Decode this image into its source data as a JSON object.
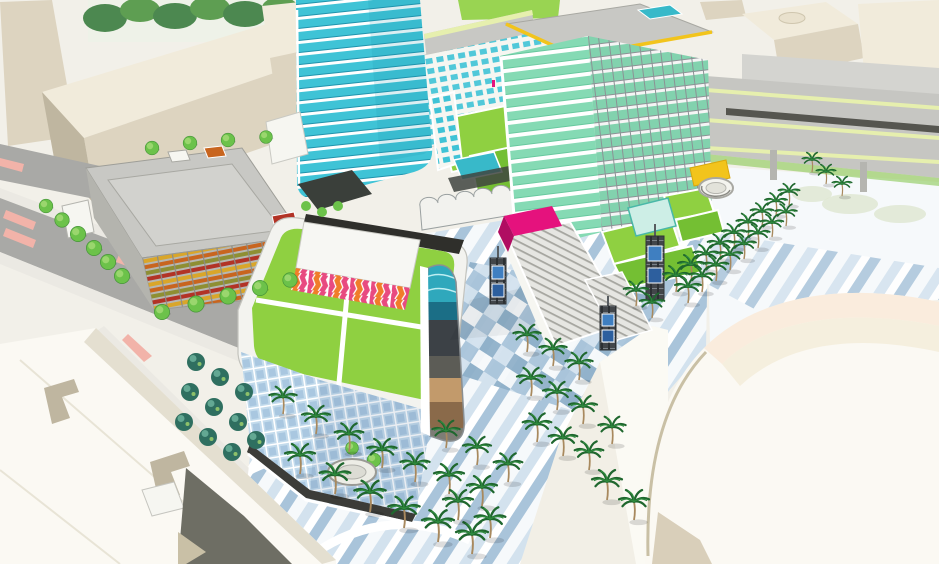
{
  "meta": {
    "title": "Aerial architectural rendering of a mixed-use transit-oriented development with towers, green roofs, palm-lined plaza, parking garage, elevated rail and arena"
  },
  "palette": {
    "bg": "#f2f0e9",
    "street": "#a9a9a6",
    "street_dark": "#80807b",
    "sidewalk": "#ebe9e3",
    "crosswalk_pink": "#f2b3a9",
    "massing_light": "#f1ebdb",
    "massing_mid": "#ddd4c0",
    "massing_dark": "#bfb6a0",
    "tree_green": "#6cc24a",
    "tree_dark": "#47953a",
    "bosque_teal": "#2f6f60",
    "bosque_light": "#63a893",
    "palm_green": "#2f8b3e",
    "palm_dark": "#1f672e",
    "palm_trunk": "#a8895e",
    "tower_cyan": "#3fc3d6",
    "tower_cyan_deep": "#1f93ac",
    "tower_mint": "#85dab4",
    "tower_mint_deep": "#67c89e",
    "mullion": "#8f9699",
    "band_white": "#ffffff",
    "roof_gray": "#c8c8c4",
    "roof_yellow": "#f2c41c",
    "rail_gray": "#c6c6c2",
    "rail_yellow": "#e6efae",
    "rail_dark": "#55554f",
    "lawn": "#8fd041",
    "lawn_deep": "#74bf33",
    "garage_gray": "#b7b7b1",
    "louver_orange": "#c8651f",
    "louver_red": "#b23326",
    "louver_olive": "#8e8f33",
    "louver_amber": "#d9a62a",
    "chevron_pink": "#e84a80",
    "chevron_orange": "#f07d2a",
    "glass_blue": "#c3dbec",
    "glass_blue_deep": "#8fb4d4",
    "mural_teal": "#2fa8bc",
    "mural_deep": "#1b6e86",
    "mural_dark": "#3c4146",
    "mural_tan": "#c29a6b",
    "mural_brown": "#8a6a4a",
    "plaza_white": "#f6f9fb",
    "plaza_blue1": "#d3e2ee",
    "plaza_blue2": "#a9c4da",
    "plaza_blue3": "#8fb0c9",
    "magenta": "#e5127d",
    "magenta_deep": "#b00d62",
    "steel": "#45494c",
    "screen_blue": "#3f7fc1",
    "arena_white": "#fbf9f3",
    "arena_peach": "#f9e7d3",
    "arena_cream": "#f4ecd8",
    "arena_line": "#c9c0a5",
    "pool": "#38b9c9",
    "canopy_dark": "#3a3f3a",
    "white_soft": "#f6f6f1"
  },
  "scene": {
    "elements": [
      {
        "name": "cyan-glass-tower",
        "description": "curved curtain-wall tower, cyan glass with white floor bands, upper left of center"
      },
      {
        "name": "mint-glass-tower",
        "description": "13-story tower, mint green glass, rounded white balcony bands, gray roof with yellow trim and rooftop pool"
      },
      {
        "name": "central-green-roof-building",
        "description": "podium building with rooftop lawn and white walkways"
      },
      {
        "name": "chevron-rooftop-pavilion",
        "description": "rooftop volume clad in pink/orange zigzag chevron pattern"
      },
      {
        "name": "mural-corner-screen",
        "description": "curved corner art wall with teal wave and earth-tone bands"
      },
      {
        "name": "parking-garage",
        "description": "garage with multicolored orange/red/olive louvers and gray roof deck"
      },
      {
        "name": "midrise-residential-block",
        "description": "white bar building with teal windows, green roof terraces, scalloped canopy"
      },
      {
        "name": "grand-stair",
        "description": "wide plaza staircase with magenta escalator canopy"
      },
      {
        "name": "plaza-paving",
        "description": "white and blue striped/checkered paving"
      },
      {
        "name": "lattice-art-towers",
        "description": "dark steel trellis towers with blue media screens"
      },
      {
        "name": "palm-trees",
        "description": "rows of palms lining promenades and sidewalks"
      },
      {
        "name": "bosque-tree-grid",
        "description": "grid of dark teal trees near street"
      },
      {
        "name": "elevated-rail-viaduct",
        "description": "gray elevated guideways with pale yellow edges, upper right"
      },
      {
        "name": "arena-roof",
        "description": "large white/cream curved arena roof, lower right"
      },
      {
        "name": "white-lowrise-block",
        "description": "white massing block with L-shaped roof cutouts, lower left"
      },
      {
        "name": "beige-massing-blocks",
        "description": "abstract beige context buildings, top edges"
      },
      {
        "name": "yellow-pavilion-and-spiral-kiosk",
        "description": "yellow canopy box with white oval ramp structure"
      },
      {
        "name": "streets",
        "description": "gray streets with pink crosswalks and street trees"
      }
    ]
  }
}
